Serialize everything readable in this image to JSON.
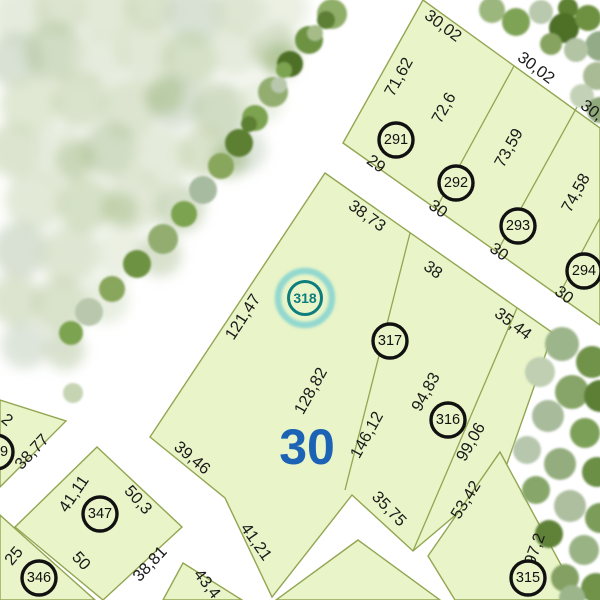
{
  "map": {
    "block_number": "30",
    "selected_parcel_number": "318"
  },
  "colors": {
    "parcel_fill": "#e9f4c8",
    "parcel_stroke": "#92a651",
    "dimension_text": "#1a1a1a",
    "block_number_text": "#1c63b5",
    "selection_ring": "#0e7d7d",
    "selection_halo": "#93d8cf"
  },
  "parcel_numbers": [
    {
      "number": "291"
    },
    {
      "number": "292"
    },
    {
      "number": "293"
    },
    {
      "number": "294"
    },
    {
      "number": "317"
    },
    {
      "number": "316"
    },
    {
      "number": "315"
    },
    {
      "number": "347"
    },
    {
      "number": "346"
    },
    {
      "number": "9"
    }
  ],
  "selected": {
    "number": "318"
  },
  "dimensions": [
    {
      "text": "30,02"
    },
    {
      "text": "30,02"
    },
    {
      "text": "30,02"
    },
    {
      "text": "71,62"
    },
    {
      "text": "72,6"
    },
    {
      "text": "73,59"
    },
    {
      "text": "74,58"
    },
    {
      "text": "29"
    },
    {
      "text": "30"
    },
    {
      "text": "30"
    },
    {
      "text": "30"
    },
    {
      "text": "38,73"
    },
    {
      "text": "38"
    },
    {
      "text": "35,44"
    },
    {
      "text": "121,47"
    },
    {
      "text": "128,82"
    },
    {
      "text": "146,12"
    },
    {
      "text": "94,83"
    },
    {
      "text": "99,06"
    },
    {
      "text": "53,42"
    },
    {
      "text": "35,75"
    },
    {
      "text": "39,46"
    },
    {
      "text": "41,21"
    },
    {
      "text": "38,77"
    },
    {
      "text": "2"
    },
    {
      "text": "41,11"
    },
    {
      "text": "50,3"
    },
    {
      "text": "50"
    },
    {
      "text": "38,81"
    },
    {
      "text": "25"
    },
    {
      "text": "43,4"
    },
    {
      "text": "97,2"
    }
  ]
}
